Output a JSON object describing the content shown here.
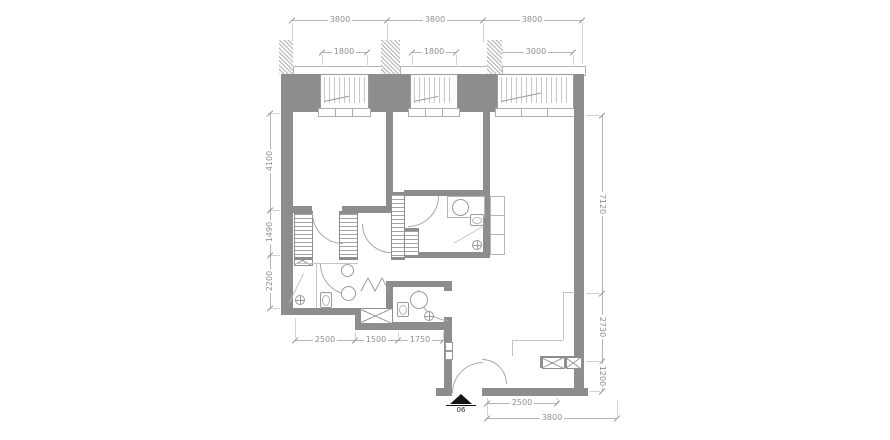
{
  "drawing": {
    "type": "apartment-floor-plan",
    "unit_marker": "06"
  },
  "colors": {
    "wall": "#8d8d8d",
    "fixture_line": "#9a9a9a",
    "dimension_text": "#8f8f8f",
    "background": "#ffffff",
    "entrance_marker": "#151515"
  },
  "dimensions": {
    "top_overall": [
      {
        "label": "3800"
      },
      {
        "label": "3800"
      },
      {
        "label": "3800"
      }
    ],
    "top_openings": [
      {
        "label": "1800"
      },
      {
        "label": "1800"
      },
      {
        "label": "3000"
      }
    ],
    "left": [
      {
        "label": "4100"
      },
      {
        "label": "1490"
      },
      {
        "label": "2200"
      }
    ],
    "right": [
      {
        "label": "7120"
      },
      {
        "label": "2730"
      },
      {
        "label": "1200"
      }
    ],
    "bottom_inner": [
      {
        "label": "2500"
      },
      {
        "label": "1500"
      },
      {
        "label": "1750"
      }
    ],
    "bottom_outer": [
      {
        "label": "2500"
      },
      {
        "label": "3800"
      }
    ]
  },
  "entrance": {
    "marker": "06"
  }
}
